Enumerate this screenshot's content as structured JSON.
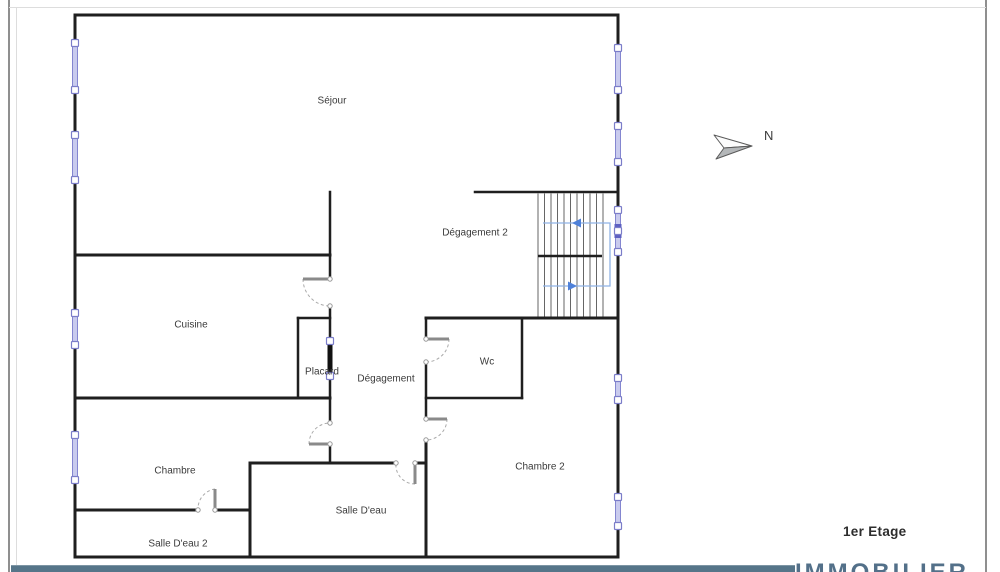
{
  "compass": {
    "label": "N"
  },
  "footer": {
    "floor_label": "1er Etage",
    "watermark": "IMMOBILIER"
  },
  "rooms": [
    {
      "name": "Séjour",
      "x": 332,
      "y": 100
    },
    {
      "name": "Dégagement 2",
      "x": 475,
      "y": 232
    },
    {
      "name": "Cuisine",
      "x": 191,
      "y": 324
    },
    {
      "name": "Placard",
      "x": 322,
      "y": 371
    },
    {
      "name": "Dégagement",
      "x": 386,
      "y": 378
    },
    {
      "name": "Wc",
      "x": 487,
      "y": 361
    },
    {
      "name": "Chambre",
      "x": 175,
      "y": 470
    },
    {
      "name": "Chambre 2",
      "x": 540,
      "y": 466
    },
    {
      "name": "Salle D'eau",
      "x": 361,
      "y": 510
    },
    {
      "name": "Salle D'eau 2",
      "x": 178,
      "y": 543
    }
  ],
  "plan": {
    "colors": {
      "wall": "#1f1f1f",
      "tread": "#555555",
      "window_fill": "#c9cbee",
      "window_stroke": "#8486d0",
      "window_dark": "#5d60c2",
      "handle_stroke": "#7b7dc9",
      "leaf": "#8a8a8a",
      "arc": "#aaaaaa",
      "dot": "#999999",
      "stair_path": "#8fb2e5",
      "stair_arrow": "#4f81d9",
      "label": "#3a3a3a"
    },
    "walls": [
      [
        75,
        15,
        618,
        15,
        3
      ],
      [
        75,
        15,
        75,
        557,
        3
      ],
      [
        75,
        557,
        618,
        557,
        3
      ],
      [
        618,
        15,
        618,
        557,
        3
      ],
      [
        75,
        255,
        330,
        255,
        3
      ],
      [
        330,
        192,
        330,
        279,
        2.5
      ],
      [
        475,
        192,
        618,
        192,
        2.5
      ],
      [
        330,
        306,
        330,
        344,
        2.5
      ],
      [
        298,
        318,
        330,
        318,
        2.5
      ],
      [
        298,
        318,
        298,
        398,
        2.5
      ],
      [
        330,
        373,
        330,
        423,
        2.5
      ],
      [
        75,
        398,
        330,
        398,
        3
      ],
      [
        426,
        318,
        618,
        318,
        3
      ],
      [
        426,
        318,
        426,
        339,
        2.5
      ],
      [
        426,
        362,
        426,
        419,
        2.5
      ],
      [
        522,
        318,
        522,
        398,
        2.5
      ],
      [
        426,
        398,
        522,
        398,
        2.5
      ],
      [
        426,
        440,
        426,
        557,
        3
      ],
      [
        250,
        463,
        396,
        463,
        3
      ],
      [
        415,
        463,
        426,
        463,
        3
      ],
      [
        250,
        463,
        250,
        557,
        3
      ],
      [
        75,
        510,
        198,
        510,
        3
      ],
      [
        215,
        510,
        250,
        510,
        3
      ],
      [
        330,
        444,
        330,
        463,
        2.5
      ]
    ],
    "windows": [
      {
        "x": 75,
        "y1": 43,
        "y2": 90
      },
      {
        "x": 75,
        "y1": 135,
        "y2": 180
      },
      {
        "x": 75,
        "y1": 313,
        "y2": 345
      },
      {
        "x": 75,
        "y1": 435,
        "y2": 480
      },
      {
        "x": 618,
        "y1": 48,
        "y2": 90
      },
      {
        "x": 618,
        "y1": 126,
        "y2": 162
      },
      {
        "x": 618,
        "y1": 210,
        "y2": 252,
        "dark": true
      },
      {
        "x": 618,
        "y1": 378,
        "y2": 400
      },
      {
        "x": 618,
        "y1": 497,
        "y2": 526
      }
    ],
    "doors": [
      {
        "leaf": [
          330,
          279,
          303,
          279
        ],
        "arc": "M303,279 A27,27 0 0 0 330,306",
        "dots": [
          [
            330,
            279
          ],
          [
            330,
            306
          ]
        ]
      },
      {
        "leaf": [
          426,
          339,
          449,
          339
        ],
        "arc": "M449,339 A23,23 0 0 1 426,362",
        "dots": [
          [
            426,
            339
          ],
          [
            426,
            362
          ]
        ]
      },
      {
        "leaf": [
          426,
          419,
          447,
          419
        ],
        "arc": "M447,419 A21,21 0 0 1 426,440",
        "dots": [
          [
            426,
            419
          ],
          [
            426,
            440
          ]
        ]
      },
      {
        "leaf": [
          330,
          444,
          309,
          444
        ],
        "arc": "M309,444 A21,21 0 0 1 330,423",
        "dots": [
          [
            330,
            444
          ],
          [
            330,
            423
          ]
        ]
      },
      {
        "leaf": [
          415,
          463,
          415,
          484
        ],
        "arc": "M415,484 A19,19 0 0 1 396,463",
        "dots": [
          [
            396,
            463
          ],
          [
            415,
            463
          ]
        ]
      },
      {
        "leaf": [
          215,
          510,
          215,
          489
        ],
        "arc": "M215,489 A20,20 0 0 0 198,510",
        "dots": [
          [
            198,
            510
          ],
          [
            215,
            510
          ]
        ]
      }
    ],
    "placard_door": {
      "x": 330,
      "y1": 341,
      "y2": 376
    },
    "stairs": {
      "x1": 538,
      "x2": 603,
      "step": 6.5,
      "y1": 192,
      "y2": 318,
      "mid": [
        538,
        256,
        602,
        256
      ],
      "path": "543,286 610,286 610,223 543,223",
      "arrows": [
        {
          "x": 570,
          "y": 286,
          "dir": "right"
        },
        {
          "x": 579,
          "y": 223,
          "dir": "left"
        }
      ]
    },
    "north_arrow": {
      "tip": [
        752,
        146
      ],
      "top": [
        714,
        135
      ],
      "notch": [
        724,
        148
      ],
      "bottom": [
        716,
        159
      ]
    }
  }
}
